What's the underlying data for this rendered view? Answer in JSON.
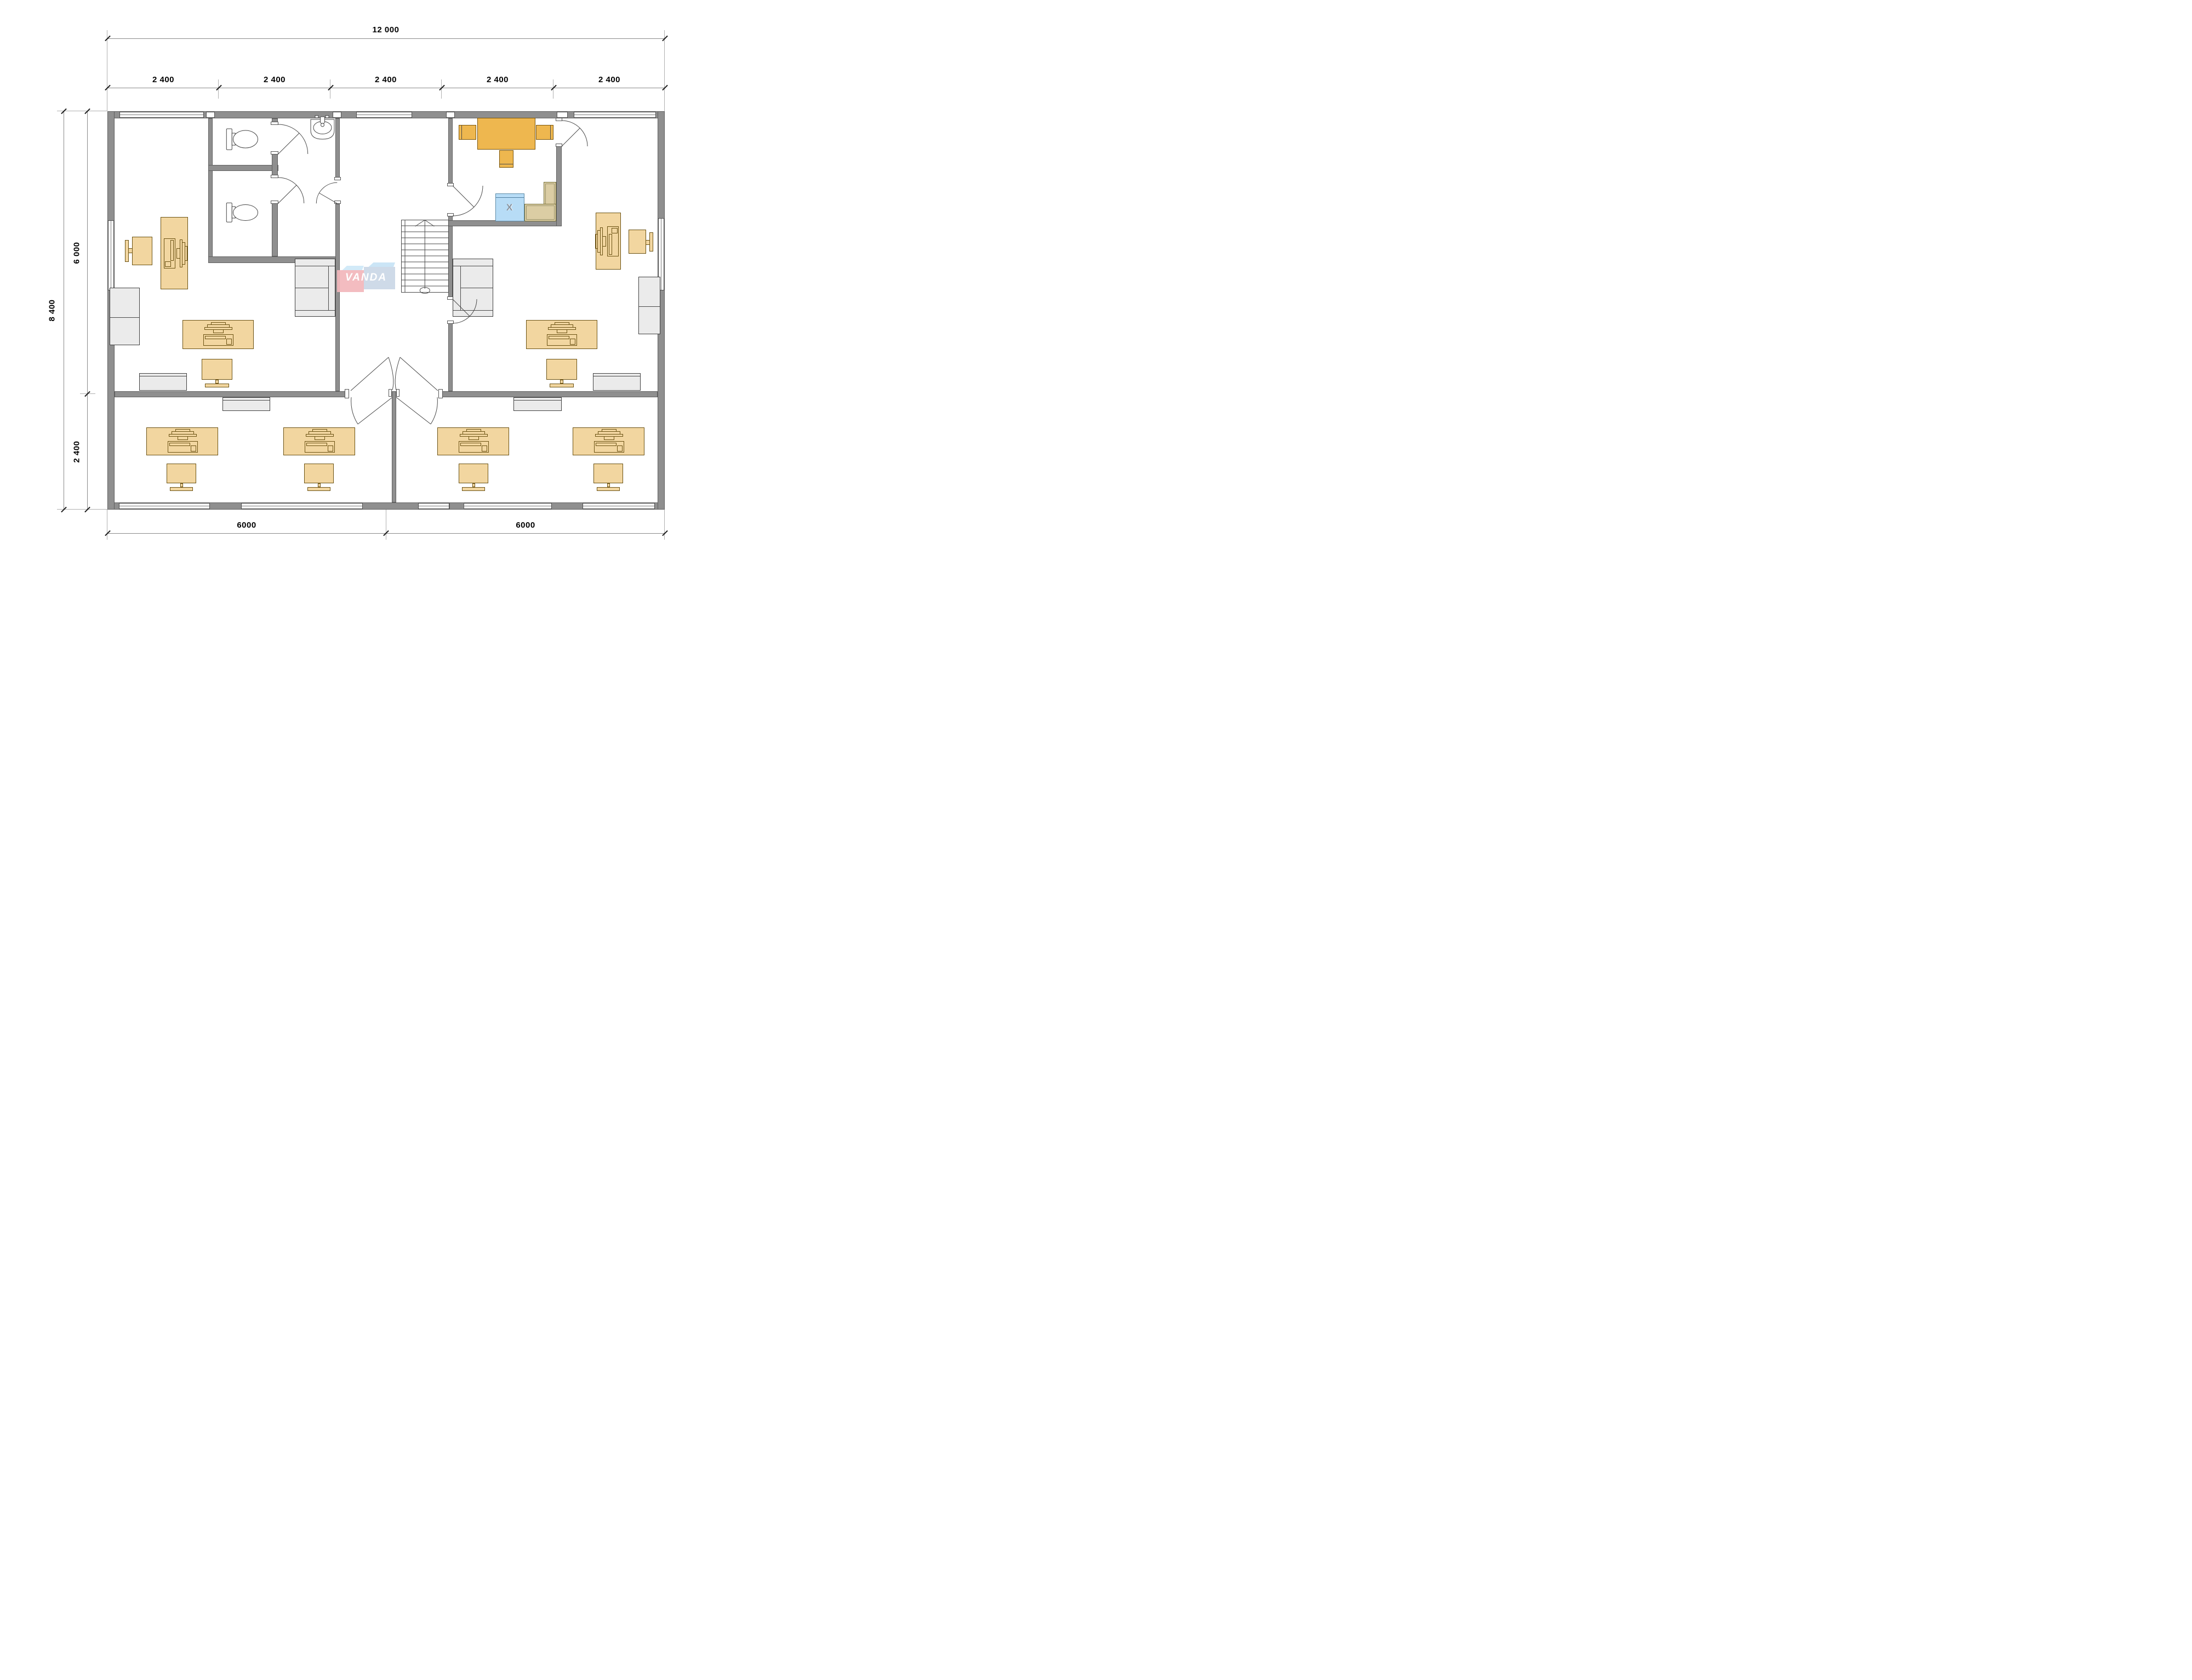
{
  "dimensions": {
    "total_width_label": "12 000",
    "top_segments": [
      "2 400",
      "2 400",
      "2 400",
      "2 400",
      "2 400"
    ],
    "total_height_label": "8 400",
    "left_segments": [
      "6 000",
      "2 400"
    ],
    "bottom_segments": [
      "6000",
      "6000"
    ]
  },
  "watermark": {
    "brand": "VANDA"
  },
  "kitchen": {
    "appliance_marker": "X"
  },
  "colors": {
    "wall_gray": "#8f8f8f",
    "desk_tan": "#f2d6a0",
    "kitchen_orange": "#eeb74f",
    "counter_tan": "#dbcda4",
    "appliance_blue": "#b7dcf6",
    "furniture_gray": "#ebebeb",
    "logo_pink": "#f3b7bc",
    "logo_blue": "#c8e4f6"
  }
}
